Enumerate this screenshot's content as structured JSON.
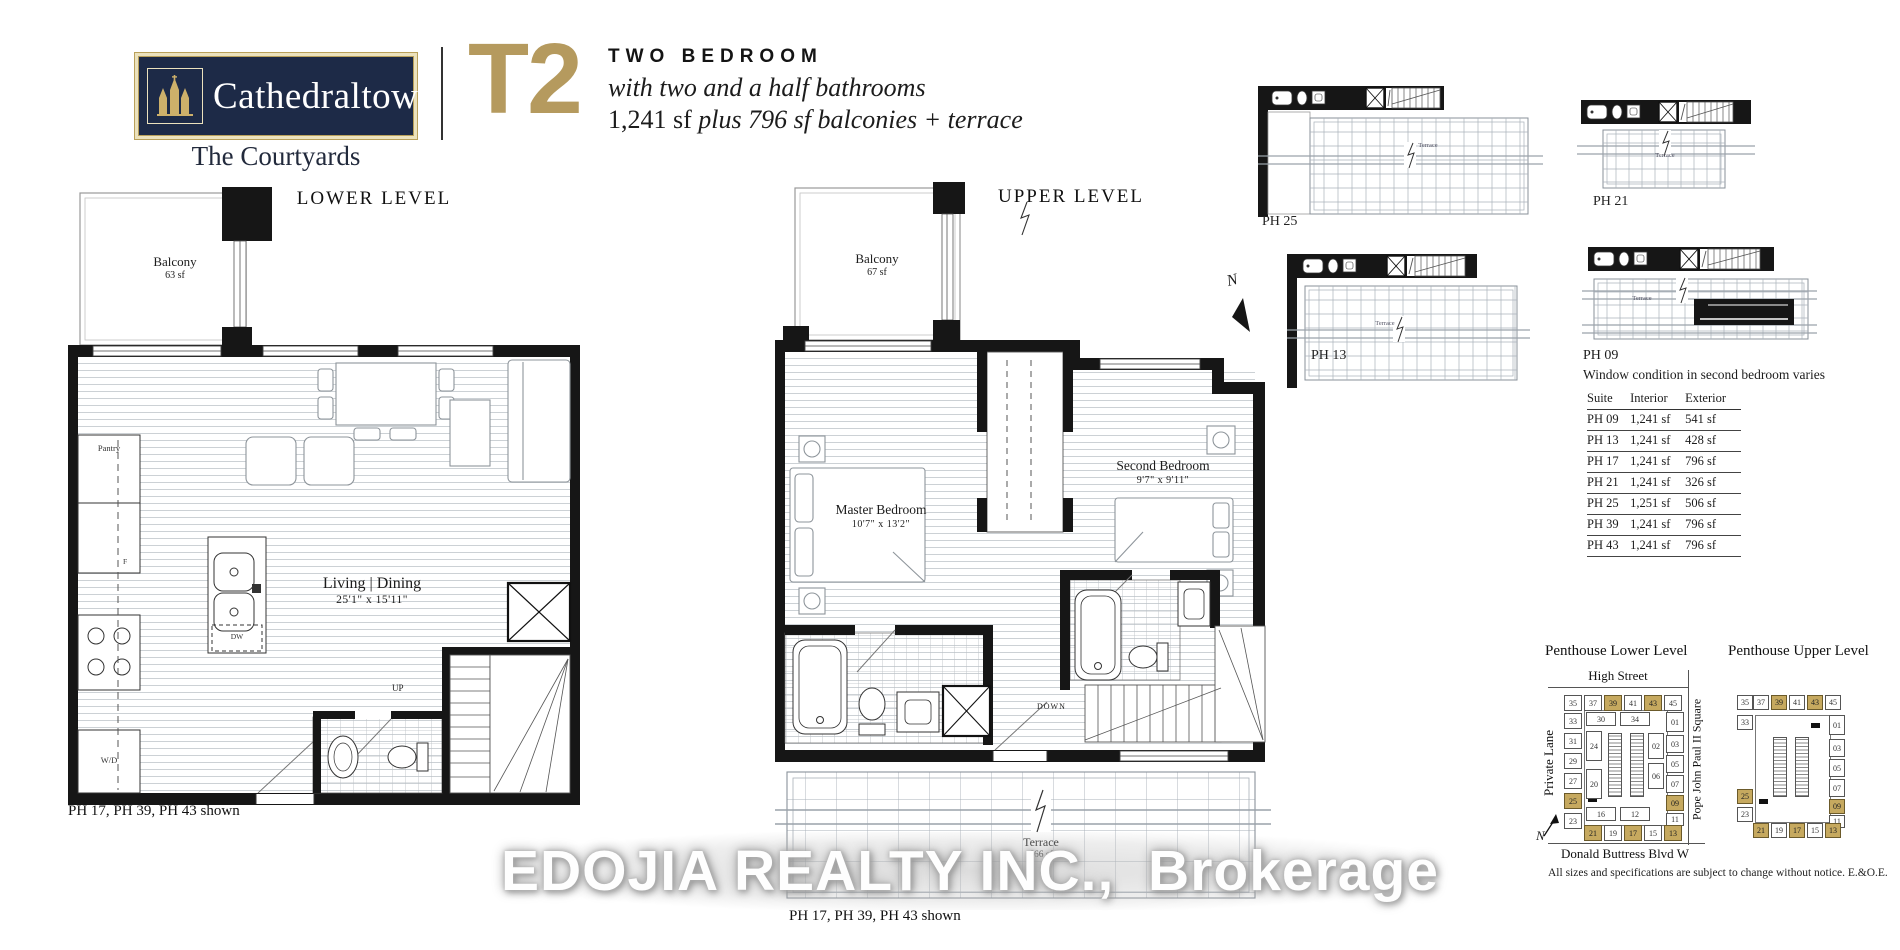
{
  "header": {
    "brand": "Cathedraltown",
    "brand_sub": "The Courtyards",
    "unit_code": "T2",
    "type_line": "TWO BEDROOM",
    "desc_line": "with two and a half bathrooms",
    "size_roman": "1,241 sf ",
    "size_italic": "plus 796 sf balconies + terrace"
  },
  "lower_level": {
    "title": "LOWER LEVEL",
    "balcony": "Balcony",
    "balcony_sf": "63 sf",
    "pantry": "Pantry",
    "fridge": "F",
    "washer_dryer": "W/D",
    "dishwasher": "DW",
    "up": "UP",
    "room": "Living | Dining",
    "room_dim": "25'1\" x 15'11\"",
    "caption": "PH 17, PH 39, PH 43 shown"
  },
  "upper_level": {
    "title": "UPPER LEVEL",
    "balcony": "Balcony",
    "balcony_sf": "67 sf",
    "master": "Master Bedroom",
    "master_dim": "10'7\" x 13'2\"",
    "second": "Second Bedroom",
    "second_dim": "9'7\" x 9'11\"",
    "down": "DOWN",
    "north": "N",
    "terrace": "Terrace",
    "terrace_sf": "666 sf",
    "caption": "PH 17, PH 39, PH 43 shown"
  },
  "mini_plans": [
    {
      "label": "PH 25",
      "terrace": "Terrace"
    },
    {
      "label": "PH 21",
      "terrace": "Terrace"
    },
    {
      "label": "PH 13",
      "terrace": "Terrace"
    },
    {
      "label": "PH 09",
      "terrace": "Terrace"
    }
  ],
  "window_note": "Window condition in second bedroom varies",
  "suite_table": {
    "headers": [
      "Suite",
      "Interior",
      "Exterior"
    ],
    "rows": [
      [
        "PH 09",
        "1,241 sf",
        "541 sf"
      ],
      [
        "PH 13",
        "1,241 sf",
        "428 sf"
      ],
      [
        "PH 17",
        "1,241 sf",
        "796 sf"
      ],
      [
        "PH 21",
        "1,241 sf",
        "326 sf"
      ],
      [
        "PH 25",
        "1,251 sf",
        "506 sf"
      ],
      [
        "PH 39",
        "1,241 sf",
        "796 sf"
      ],
      [
        "PH 43",
        "1,241 sf",
        "796 sf"
      ]
    ]
  },
  "key_plans": {
    "lower_title": "Penthouse Lower Level",
    "upper_title": "Penthouse Upper Level",
    "street_top": "High Street",
    "street_left": "Private Lane",
    "street_right": "Pope John Paul II Square",
    "street_bottom": "Donald Buttress Blvd W",
    "north": "N",
    "lower_units": [
      {
        "n": "35"
      },
      {
        "n": "37"
      },
      {
        "n": "39",
        "hl": true
      },
      {
        "n": "41"
      },
      {
        "n": "43",
        "hl": true
      },
      {
        "n": "45"
      },
      {
        "n": "33"
      },
      {
        "n": "31"
      },
      {
        "n": "29"
      },
      {
        "n": "27"
      },
      {
        "n": "25",
        "hl": true
      },
      {
        "n": "23"
      },
      {
        "n": "30"
      },
      {
        "n": "34"
      },
      {
        "n": "24"
      },
      {
        "n": "20"
      },
      {
        "n": "16"
      },
      {
        "n": "12"
      },
      {
        "n": "01"
      },
      {
        "n": "02"
      },
      {
        "n": "03"
      },
      {
        "n": "05"
      },
      {
        "n": "06"
      },
      {
        "n": "07"
      },
      {
        "n": "09",
        "hl": true
      },
      {
        "n": "11"
      },
      {
        "n": "21",
        "hl": true
      },
      {
        "n": "19"
      },
      {
        "n": "17",
        "hl": true
      },
      {
        "n": "15"
      },
      {
        "n": "13",
        "hl": true
      }
    ],
    "upper_units": [
      {
        "n": "35"
      },
      {
        "n": "37"
      },
      {
        "n": "39",
        "hl": true
      },
      {
        "n": "41"
      },
      {
        "n": "43",
        "hl": true
      },
      {
        "n": "45"
      },
      {
        "n": "33"
      },
      {
        "n": "25",
        "hl": true
      },
      {
        "n": "23"
      },
      {
        "n": "01"
      },
      {
        "n": "03"
      },
      {
        "n": "05"
      },
      {
        "n": "07"
      },
      {
        "n": "09",
        "hl": true
      },
      {
        "n": "11"
      },
      {
        "n": "21",
        "hl": true
      },
      {
        "n": "19"
      },
      {
        "n": "17",
        "hl": true
      },
      {
        "n": "15"
      },
      {
        "n": "13",
        "hl": true
      }
    ],
    "footnote": "All sizes and specifications are subject to change without notice. E.&O.E."
  },
  "watermark": "EDOJIA REALTY INC.,  Brokerage",
  "colors": {
    "navy": "#1d2a47",
    "gold": "#b59a5e",
    "highlight": "#c6a95f",
    "logo_trim": "#ece2bd"
  }
}
